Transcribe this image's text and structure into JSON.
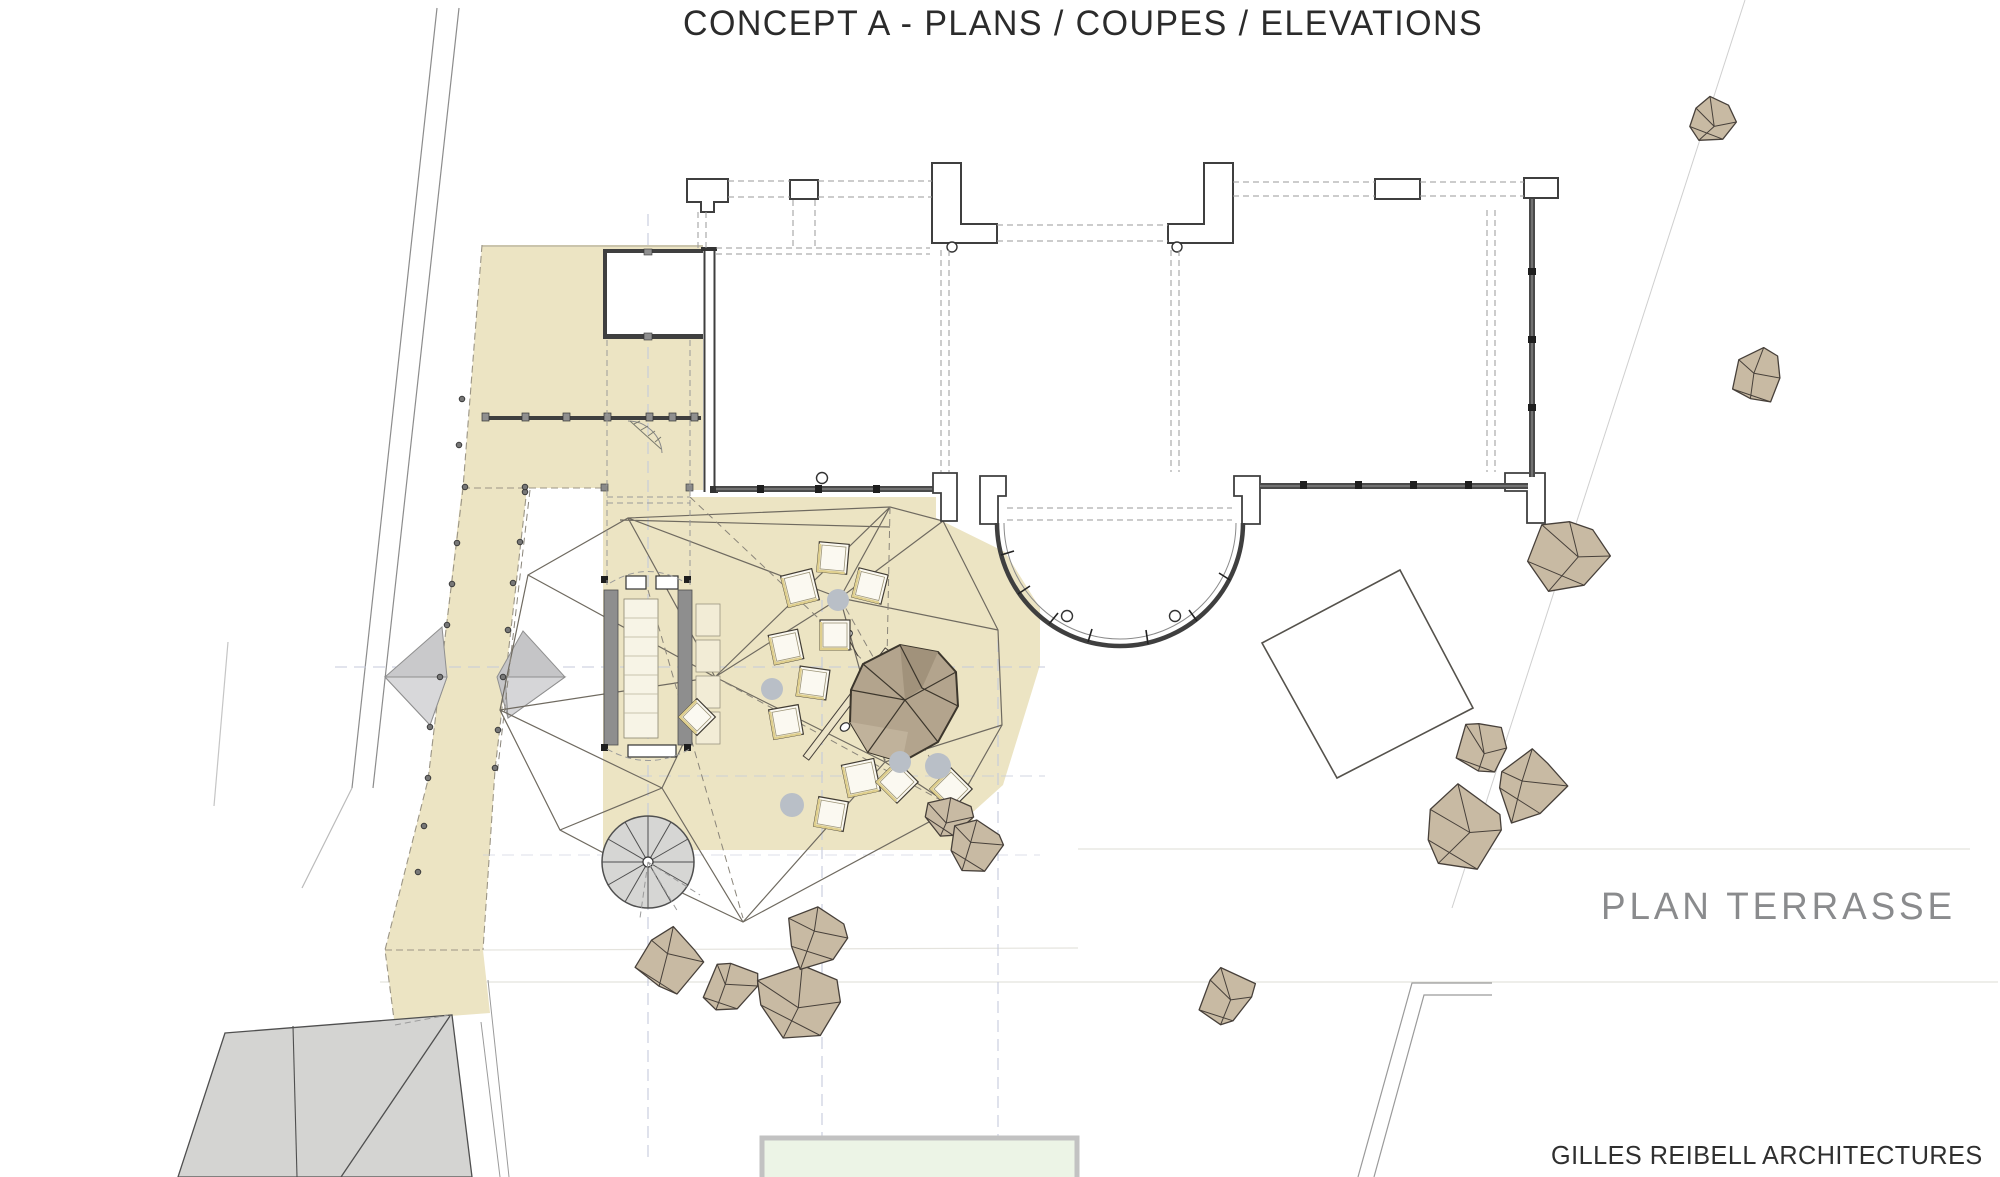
{
  "title": "CONCEPT A - PLANS / COUPES / ELEVATIONS",
  "drawing_label": "PLAN TERRASSE",
  "firm": "GILLES REIBELL ARCHITECTURES",
  "colors": {
    "paper": "#ffffff",
    "terrace": "#ece4c3",
    "terrace_edge": "#9b9585",
    "ink": "#3f3f3f",
    "wireframe": "#6f6a60",
    "rock_fill": "#c8baa3",
    "rock_line": "#47403a",
    "boulder_fill": "#b3a48d",
    "roof_gray": "#d4d4d2",
    "pouf_gray": "#b9bfc7",
    "axis_lavender": "#c5cadb",
    "pool_green": "#ecf4e6",
    "pool_edge": "#c2c2c2",
    "table_accent": "#dfcf8e",
    "label_gray": "#8a8b8d",
    "text_dark": "#2b2b2b"
  },
  "plan": {
    "rocks": [
      {
        "cx": 1713,
        "cy": 122,
        "r": 27,
        "seed": 11
      },
      {
        "cx": 1758,
        "cy": 378,
        "r": 30,
        "seed": 23
      },
      {
        "cx": 1570,
        "cy": 556,
        "r": 44,
        "seed": 35
      },
      {
        "cx": 1484,
        "cy": 748,
        "r": 29,
        "seed": 47
      },
      {
        "cx": 1529,
        "cy": 786,
        "r": 40,
        "seed": 59
      },
      {
        "cx": 1463,
        "cy": 830,
        "r": 46,
        "seed": 71
      },
      {
        "cx": 947,
        "cy": 817,
        "r": 26,
        "seed": 83
      },
      {
        "cx": 977,
        "cy": 845,
        "r": 30,
        "seed": 95
      },
      {
        "cx": 1227,
        "cy": 997,
        "r": 33,
        "seed": 107
      },
      {
        "cx": 670,
        "cy": 962,
        "r": 36,
        "seed": 119
      },
      {
        "cx": 733,
        "cy": 986,
        "r": 31,
        "seed": 131
      },
      {
        "cx": 795,
        "cy": 1002,
        "r": 46,
        "seed": 143
      },
      {
        "cx": 818,
        "cy": 938,
        "r": 35,
        "seed": 155
      }
    ],
    "tables": [
      {
        "x": 833,
        "y": 558,
        "s": 30,
        "rot": 5
      },
      {
        "x": 800,
        "y": 588,
        "s": 32,
        "rot": -14
      },
      {
        "x": 870,
        "y": 586,
        "s": 30,
        "rot": 14
      },
      {
        "x": 835,
        "y": 635,
        "s": 30,
        "rot": 0
      },
      {
        "x": 786,
        "y": 647,
        "s": 30,
        "rot": -12
      },
      {
        "x": 813,
        "y": 683,
        "s": 30,
        "rot": 8
      },
      {
        "x": 786,
        "y": 722,
        "s": 30,
        "rot": -10
      },
      {
        "x": 697,
        "y": 717,
        "s": 26,
        "rot": 45
      },
      {
        "x": 861,
        "y": 778,
        "s": 33,
        "rot": -12
      },
      {
        "x": 831,
        "y": 814,
        "s": 30,
        "rot": 10
      },
      {
        "x": 897,
        "y": 782,
        "s": 30,
        "rot": 45
      },
      {
        "x": 951,
        "y": 789,
        "s": 30,
        "rot": 45
      }
    ],
    "poufs": [
      {
        "cx": 838,
        "cy": 600,
        "r": 11
      },
      {
        "cx": 772,
        "cy": 689,
        "r": 11
      },
      {
        "cx": 900,
        "cy": 762,
        "r": 11
      },
      {
        "cx": 938,
        "cy": 766,
        "r": 13
      },
      {
        "cx": 792,
        "cy": 805,
        "r": 12
      }
    ],
    "walkway_dots": [
      [
        462,
        399
      ],
      [
        459,
        445
      ],
      [
        465,
        487
      ],
      [
        457,
        543
      ],
      [
        452,
        584
      ],
      [
        447,
        625
      ],
      [
        440,
        677
      ],
      [
        430,
        727
      ],
      [
        428,
        778
      ],
      [
        424,
        826
      ],
      [
        418,
        872
      ],
      [
        525,
        492
      ],
      [
        520,
        542
      ],
      [
        513,
        583
      ],
      [
        508,
        630
      ],
      [
        503,
        677
      ],
      [
        498,
        730
      ],
      [
        495,
        768
      ],
      [
        525,
        487
      ]
    ]
  }
}
